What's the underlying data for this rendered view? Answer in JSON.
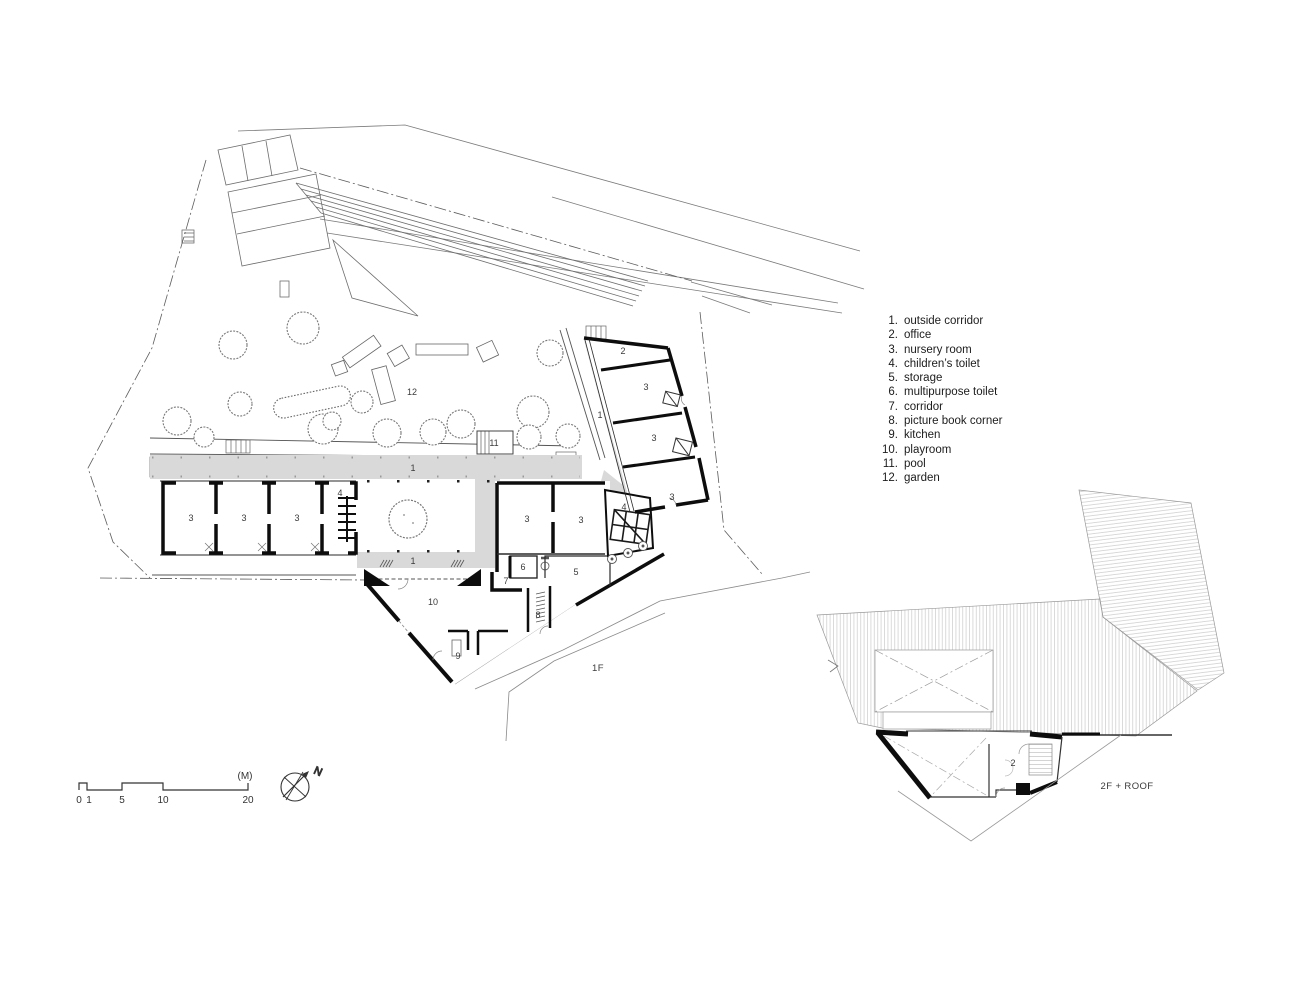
{
  "legend": {
    "items": [
      {
        "num": "1.",
        "label": "outside corridor"
      },
      {
        "num": "2.",
        "label": "office"
      },
      {
        "num": "3.",
        "label": "nursery room"
      },
      {
        "num": "4.",
        "label": "children’s toilet"
      },
      {
        "num": "5.",
        "label": "storage"
      },
      {
        "num": "6.",
        "label": "multipurpose toilet"
      },
      {
        "num": "7.",
        "label": "corridor"
      },
      {
        "num": "8.",
        "label": "picture book corner"
      },
      {
        "num": "9.",
        "label": "kitchen"
      },
      {
        "num": "10.",
        "label": "playroom"
      },
      {
        "num": "11.",
        "label": "pool"
      },
      {
        "num": "12.",
        "label": "garden"
      }
    ]
  },
  "plan_1f": {
    "floor_label": "1F",
    "rooms": {
      "garden": "12",
      "pool": "11",
      "corridor_top": "1",
      "corridor_bottom": "1",
      "corridor_right": "1",
      "office": "2",
      "nursery_a": "3",
      "nursery_b": "3",
      "nursery_c": "3",
      "nursery_d": "3",
      "nursery_e": "3",
      "nursery_f": "3",
      "nursery_g": "3",
      "nursery_h": "3",
      "toilet_left": "4",
      "toilet_center": "4",
      "storage": "5",
      "multipurpose_toilet": "6",
      "corridor": "7",
      "picture_book_corner": "8",
      "kitchen": "9",
      "playroom": "10"
    }
  },
  "plan_2f": {
    "floor_label": "2F + ROOF",
    "rooms": {
      "office": "2"
    }
  },
  "scale_bar": {
    "unit": "(M)",
    "tick0": "0",
    "tick1": "1",
    "tick5": "5",
    "tick10": "10",
    "tick20": "20"
  },
  "compass": {
    "north": "N"
  },
  "colors": {
    "line": "#2a2a2a",
    "wall": "#0d0d0d",
    "context": "#7a7a7a",
    "corridor_fill": "#d9d9d9",
    "roof_hatch": "#bdbdbd"
  }
}
